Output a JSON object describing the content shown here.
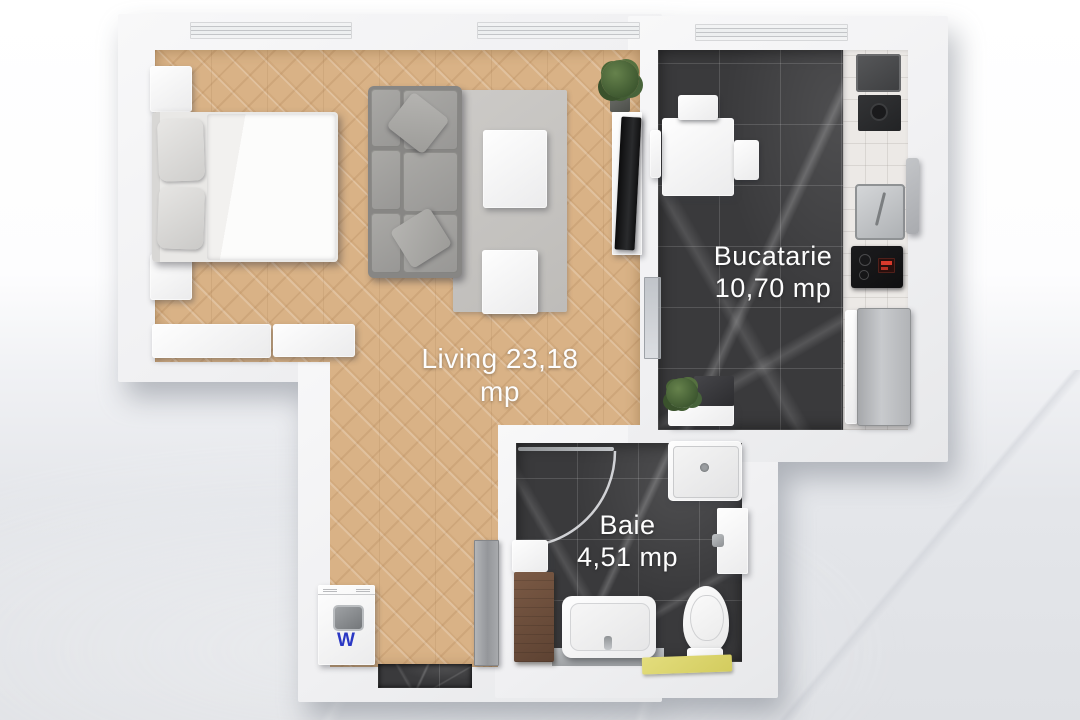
{
  "plan_title": "Apartment floor plan (top view)",
  "rooms": {
    "living": {
      "label": "Living 23,18 mp",
      "name": "Living",
      "area": "23,18 mp"
    },
    "kitchen": {
      "name": "Bucatarie",
      "area": "10,70 mp"
    },
    "bathroom": {
      "name": "Baie",
      "area": "4,51 mp"
    }
  },
  "appliances": {
    "washing_machine_label": "W"
  },
  "colors": {
    "wood_floor": "#d9b286",
    "dark_marble_tile": "#3a3a3c",
    "wall_white": "#f2f2f4",
    "rug_gray": "#c8c6c3",
    "sofa_gray": "#9a9997",
    "bath_mat_yellow": "#ddd76e",
    "washer_letter_blue": "#2b38c4",
    "cooktop_display_red": "#d93a2c"
  }
}
